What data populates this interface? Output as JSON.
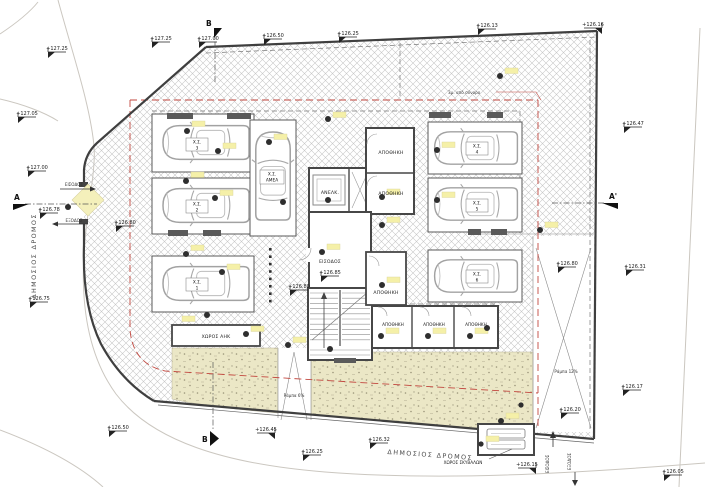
{
  "colors": {
    "setback_red": "#c2473f",
    "highlight_yellow": "#f5f0a8",
    "landscape_fill": "#ebe7c6",
    "hatch_line": "#c6c6c6",
    "wall": "#4a4a4a"
  },
  "roads": {
    "left": "ΔΗΜΟΣΙΟΣ ΔΡΟΜΟΣ",
    "bottom": "ΔΗΜΟΣΙΟΣ ΔΡΟΜΟΣ"
  },
  "sections": {
    "top": "B",
    "bottom": "B",
    "left": "A",
    "right": "A'"
  },
  "notes": {
    "boundary_offset": "3μ. από σύνορο",
    "ramp_small": "Ράμπα 6%",
    "ramp_large": "Ράμπα 12%"
  },
  "entrance_left": {
    "in": "ΕΙΣΟΔΟΣ",
    "out": "ΕΞΟΔΟΣ"
  },
  "entrance_right": {
    "in": "ΕΙΣΟΔΟΣ",
    "out": "ΕΞΟΔΟΣ"
  },
  "rooms": {
    "elevator": "ΑΝΕΛΚ.",
    "hall": "ΕΙΣΟΔΟΣ",
    "storage": "ΑΠΟΘΗΚΗ",
    "electrical": "ΧΩΡΟΣ ΑΗΚ",
    "garbage": "ΧΩΡΟΣ ΣΚΥΒΑΛΩΝ"
  },
  "parking": {
    "prefix": "Χ.Σ.",
    "numbers": [
      "1",
      "2",
      "3",
      "4",
      "5",
      "6"
    ],
    "disabled": "ΑΜΕΑ"
  },
  "elevations": [
    "+127.25",
    "+127.25",
    "+127.00",
    "+126.50",
    "+126.25",
    "+126.13",
    "+126.16",
    "+127.05",
    "+127.00",
    "+126.78",
    "+126.75",
    "+126.80",
    "+126.47",
    "+126.31",
    "+126.80",
    "+126.85",
    "+126.80",
    "+126.17",
    "+126.20",
    "+126.50",
    "+126.45",
    "+126.25",
    "+126.32",
    "+126.15",
    "+126.05"
  ]
}
